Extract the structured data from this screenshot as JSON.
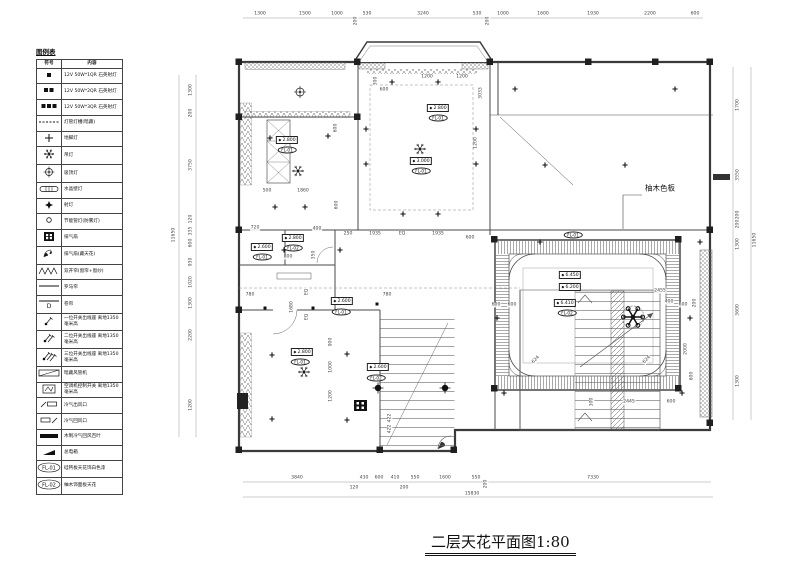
{
  "legend": {
    "title": "图例表",
    "col_symbol": "符号",
    "col_content": "内容",
    "rows": [
      {
        "sym": "sq1",
        "text": "12V 50W*1QR 石英射灯"
      },
      {
        "sym": "sq2",
        "text": "12V 50W*2QR 石英射灯"
      },
      {
        "sym": "sq3",
        "text": "12V 50W*3QR 石英射灯"
      },
      {
        "sym": "dash",
        "text": "灯管灯槽(暗藏)"
      },
      {
        "sym": "plus",
        "text": "地脚灯"
      },
      {
        "sym": "snow",
        "text": "吊灯"
      },
      {
        "sym": "target",
        "text": "吸顶灯"
      },
      {
        "sym": "pill",
        "text": "水晶壁灯"
      },
      {
        "sym": "star",
        "text": "射灯"
      },
      {
        "sym": "circ",
        "text": "节能管灯(防雾灯)"
      },
      {
        "sym": "grid",
        "text": "排气扇"
      },
      {
        "sym": "fan",
        "text": "排气扇(藏天花)"
      },
      {
        "sym": "zig",
        "text": "双开帘(窗帘+窗纱)"
      },
      {
        "sym": "line",
        "text": "罗马帘"
      },
      {
        "sym": "lineD",
        "sym_text": "D",
        "text": "卷帘"
      },
      {
        "sym": "sw1",
        "text": "一位开关出线座 离地1350毫米高"
      },
      {
        "sym": "sw2",
        "text": "二位开关出线座 离地1350毫米高"
      },
      {
        "sym": "sw3",
        "text": "三位开关出线座 离地1350毫米高"
      },
      {
        "sym": "duct",
        "text": "暗藏风管机"
      },
      {
        "sym": "acsw",
        "text": "空调机控制开关 离地1350毫米高"
      },
      {
        "sym": "vent1",
        "text": "冷气出风口"
      },
      {
        "sym": "vent2",
        "text": "冷气回风口"
      },
      {
        "sym": "bar",
        "text": "木制冷气回风百叶"
      },
      {
        "sym": "blk",
        "text": "总电箱"
      },
      {
        "sym": "fl",
        "sym_text": "FL-01",
        "text": "硅钙板天花饰白色漆"
      },
      {
        "sym": "fl",
        "sym_text": "FL-02",
        "text": "柚木饰面板天花"
      }
    ]
  },
  "plan": {
    "note_right": "柚木色板",
    "annotations": [
      {
        "t": "dim",
        "x": 105,
        "y": 9,
        "v": "1300"
      },
      {
        "t": "dim",
        "x": 150,
        "y": 9,
        "v": "1500"
      },
      {
        "t": "dim",
        "x": 182,
        "y": 9,
        "v": "1000"
      },
      {
        "t": "dim",
        "x": 201,
        "y": 16,
        "v": "200",
        "r": 90
      },
      {
        "t": "dim",
        "x": 212,
        "y": 9,
        "v": "530"
      },
      {
        "t": "dim",
        "x": 268,
        "y": 9,
        "v": "3240"
      },
      {
        "t": "dim",
        "x": 322,
        "y": 9,
        "v": "530"
      },
      {
        "t": "dim",
        "x": 333,
        "y": 16,
        "v": "200",
        "r": 90
      },
      {
        "t": "dim",
        "x": 348,
        "y": 9,
        "v": "1000"
      },
      {
        "t": "dim",
        "x": 388,
        "y": 9,
        "v": "1600"
      },
      {
        "t": "dim",
        "x": 438,
        "y": 9,
        "v": "1930"
      },
      {
        "t": "dim",
        "x": 495,
        "y": 9,
        "v": "2200"
      },
      {
        "t": "dim",
        "x": 540,
        "y": 9,
        "v": "600"
      },
      {
        "t": "dim",
        "x": 36,
        "y": 85,
        "v": "1300",
        "r": 90
      },
      {
        "t": "dim",
        "x": 36,
        "y": 108,
        "v": "200",
        "r": 90
      },
      {
        "t": "dim",
        "x": 36,
        "y": 160,
        "v": "3750",
        "r": 90
      },
      {
        "t": "dim",
        "x": 36,
        "y": 214,
        "v": "120",
        "r": 90
      },
      {
        "t": "dim",
        "x": 36,
        "y": 226,
        "v": "335",
        "r": 90
      },
      {
        "t": "dim",
        "x": 36,
        "y": 238,
        "v": "600",
        "r": 90
      },
      {
        "t": "dim",
        "x": 36,
        "y": 257,
        "v": "930",
        "r": 90
      },
      {
        "t": "dim",
        "x": 36,
        "y": 277,
        "v": "1020",
        "r": 90
      },
      {
        "t": "dim",
        "x": 36,
        "y": 298,
        "v": "1300",
        "r": 90
      },
      {
        "t": "dim",
        "x": 36,
        "y": 330,
        "v": "2200",
        "r": 90
      },
      {
        "t": "dim",
        "x": 36,
        "y": 400,
        "v": "1200",
        "r": 90
      },
      {
        "t": "dim",
        "x": 19,
        "y": 230,
        "v": "11650",
        "r": 90
      },
      {
        "t": "dim",
        "x": 583,
        "y": 100,
        "v": "1700",
        "r": 90
      },
      {
        "t": "dim",
        "x": 583,
        "y": 170,
        "v": "3550",
        "r": 90
      },
      {
        "t": "dim",
        "x": 583,
        "y": 210,
        "v": "200",
        "r": 90
      },
      {
        "t": "dim",
        "x": 583,
        "y": 219,
        "v": "200",
        "r": 90
      },
      {
        "t": "dim",
        "x": 583,
        "y": 239,
        "v": "1300",
        "r": 90
      },
      {
        "t": "dim",
        "x": 583,
        "y": 305,
        "v": "3600",
        "r": 90
      },
      {
        "t": "dim",
        "x": 583,
        "y": 376,
        "v": "1300",
        "r": 90
      },
      {
        "t": "dim",
        "x": 600,
        "y": 235,
        "v": "11650",
        "r": 90
      },
      {
        "t": "dim",
        "x": 142,
        "y": 473,
        "v": "3840"
      },
      {
        "t": "dim",
        "x": 199,
        "y": 483,
        "v": "120"
      },
      {
        "t": "dim",
        "x": 209,
        "y": 473,
        "v": "430"
      },
      {
        "t": "dim",
        "x": 224,
        "y": 473,
        "v": "600"
      },
      {
        "t": "dim",
        "x": 240,
        "y": 473,
        "v": "410"
      },
      {
        "t": "dim",
        "x": 249,
        "y": 483,
        "v": "200"
      },
      {
        "t": "dim",
        "x": 260,
        "y": 473,
        "v": "550"
      },
      {
        "t": "dim",
        "x": 290,
        "y": 473,
        "v": "1600"
      },
      {
        "t": "dim",
        "x": 321,
        "y": 473,
        "v": "550"
      },
      {
        "t": "dim",
        "x": 331,
        "y": 479,
        "v": "200",
        "r": 90
      },
      {
        "t": "dim",
        "x": 438,
        "y": 473,
        "v": "7330"
      },
      {
        "t": "dim",
        "x": 317,
        "y": 489,
        "v": "15830"
      },
      {
        "t": "dim",
        "x": 112,
        "y": 186,
        "v": "500"
      },
      {
        "t": "dim",
        "x": 148,
        "y": 186,
        "v": "1860"
      },
      {
        "t": "dim",
        "x": 181,
        "y": 123,
        "v": "600",
        "r": 90
      },
      {
        "t": "dim",
        "x": 182,
        "y": 200,
        "v": "600",
        "r": 90
      },
      {
        "t": "dim",
        "x": 272,
        "y": 72,
        "v": "1200"
      },
      {
        "t": "dim",
        "x": 307,
        "y": 72,
        "v": "1200"
      },
      {
        "t": "dim",
        "x": 221,
        "y": 76,
        "v": "300",
        "r": 90
      },
      {
        "t": "dim",
        "x": 229,
        "y": 85,
        "v": "600"
      },
      {
        "t": "dim",
        "x": 326,
        "y": 88,
        "v": "3033",
        "r": 90
      },
      {
        "t": "dim",
        "x": 321,
        "y": 138,
        "v": "1200",
        "r": 90
      },
      {
        "t": "dim",
        "x": 193,
        "y": 229,
        "v": "250"
      },
      {
        "t": "dim",
        "x": 220,
        "y": 229,
        "v": "1935"
      },
      {
        "t": "dim",
        "x": 247,
        "y": 229,
        "v": "EQ"
      },
      {
        "t": "dim",
        "x": 283,
        "y": 229,
        "v": "1935"
      },
      {
        "t": "dim",
        "x": 315,
        "y": 233,
        "v": "600"
      },
      {
        "t": "dim",
        "x": 100,
        "y": 223,
        "v": "720"
      },
      {
        "t": "dim",
        "x": 162,
        "y": 224,
        "v": "400"
      },
      {
        "t": "dim",
        "x": 133,
        "y": 252,
        "v": "800"
      },
      {
        "t": "dim",
        "x": 159,
        "y": 250,
        "v": "350",
        "r": 90
      },
      {
        "t": "dim",
        "x": 95,
        "y": 290,
        "v": "780"
      },
      {
        "t": "dim",
        "x": 232,
        "y": 290,
        "v": "780"
      },
      {
        "t": "dim",
        "x": 137,
        "y": 302,
        "v": "1680",
        "r": 90
      },
      {
        "t": "dim",
        "x": 152,
        "y": 287,
        "v": "EQ",
        "r": 90
      },
      {
        "t": "dim",
        "x": 152,
        "y": 312,
        "v": "EQ",
        "r": 90
      },
      {
        "t": "dim",
        "x": 176,
        "y": 337,
        "v": "900",
        "r": 90
      },
      {
        "t": "dim",
        "x": 176,
        "y": 362,
        "v": "1000",
        "r": 90
      },
      {
        "t": "dim",
        "x": 176,
        "y": 391,
        "v": "1200",
        "r": 90
      },
      {
        "t": "dim",
        "x": 235,
        "y": 413,
        "v": "422",
        "r": 90
      },
      {
        "t": "dim",
        "x": 235,
        "y": 424,
        "v": "422",
        "r": 90
      },
      {
        "t": "dim",
        "x": 341,
        "y": 300,
        "v": "600"
      },
      {
        "t": "dim",
        "x": 357,
        "y": 300,
        "v": "600"
      },
      {
        "t": "dim",
        "x": 514,
        "y": 297,
        "v": "400"
      },
      {
        "t": "dim",
        "x": 528,
        "y": 300,
        "v": "600"
      },
      {
        "t": "dim",
        "x": 540,
        "y": 298,
        "v": "200",
        "r": 90
      },
      {
        "t": "dim",
        "x": 531,
        "y": 344,
        "v": "2000",
        "r": 90
      },
      {
        "t": "dim",
        "x": 537,
        "y": 371,
        "v": "600",
        "r": 90
      },
      {
        "t": "dim",
        "x": 474,
        "y": 397,
        "v": "2445"
      },
      {
        "t": "dim",
        "x": 516,
        "y": 397,
        "v": "600"
      },
      {
        "t": "dim",
        "x": 437,
        "y": 397,
        "v": "300",
        "r": 90
      },
      {
        "t": "dim",
        "x": 381,
        "y": 355,
        "v": "624",
        "r": -45
      },
      {
        "t": "dim",
        "x": 492,
        "y": 355,
        "v": "624",
        "r": -45
      },
      {
        "t": "dim",
        "x": 505,
        "y": 286,
        "v": "2455"
      },
      {
        "t": "elev",
        "x": 132,
        "y": 135,
        "v": "2.800"
      },
      {
        "t": "oval",
        "x": 132,
        "y": 145,
        "v": "FL-01"
      },
      {
        "t": "elev",
        "x": 283,
        "y": 103,
        "v": "2.800"
      },
      {
        "t": "oval",
        "x": 283,
        "y": 113,
        "v": "FL-01"
      },
      {
        "t": "elev",
        "x": 266,
        "y": 156,
        "v": "3.000"
      },
      {
        "t": "oval",
        "x": 266,
        "y": 166,
        "v": "FL-01"
      },
      {
        "t": "elev",
        "x": 107,
        "y": 242,
        "v": "2.600"
      },
      {
        "t": "oval",
        "x": 107,
        "y": 252,
        "v": "FL-01"
      },
      {
        "t": "elev",
        "x": 138,
        "y": 233,
        "v": "2.800"
      },
      {
        "t": "oval",
        "x": 138,
        "y": 243,
        "v": "FL-02"
      },
      {
        "t": "elev",
        "x": 187,
        "y": 296,
        "v": "2.600"
      },
      {
        "t": "oval",
        "x": 186,
        "y": 307,
        "v": "FL-01"
      },
      {
        "t": "elev",
        "x": 147,
        "y": 347,
        "v": "2.800"
      },
      {
        "t": "oval",
        "x": 145,
        "y": 357,
        "v": "FL-01"
      },
      {
        "t": "elev",
        "x": 223,
        "y": 362,
        "v": "2.600"
      },
      {
        "t": "oval",
        "x": 221,
        "y": 373,
        "v": "FL-02"
      },
      {
        "t": "elev",
        "x": 415,
        "y": 270,
        "v": "6.450"
      },
      {
        "t": "elev",
        "x": 415,
        "y": 282,
        "v": "6.200"
      },
      {
        "t": "elev",
        "x": 410,
        "y": 298,
        "v": "6.410"
      },
      {
        "t": "oval",
        "x": 412,
        "y": 308,
        "v": "FL-02"
      },
      {
        "t": "oval",
        "x": 418,
        "y": 230,
        "v": "FL-01"
      }
    ]
  },
  "title_block": {
    "text": "二层天花平面图1:80"
  }
}
